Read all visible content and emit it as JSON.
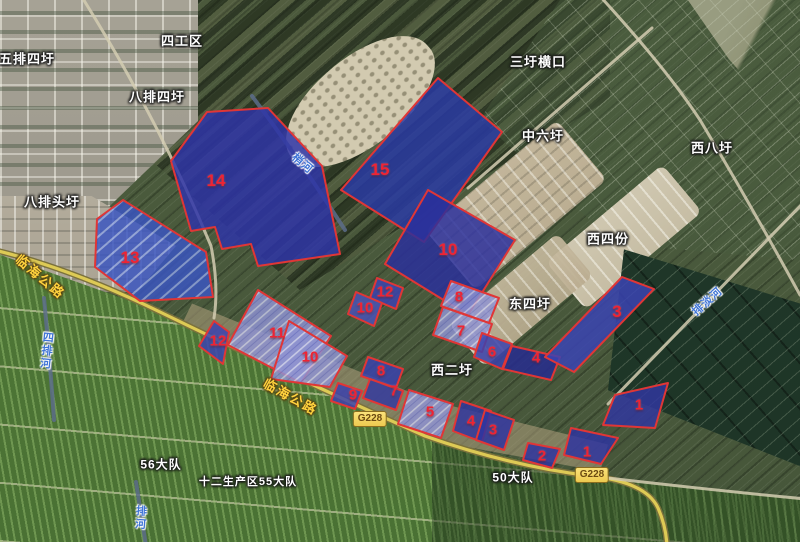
{
  "map": {
    "description": "satellite farmland map with numbered highlighted parcels",
    "colors": {
      "parcel_border": "#e03636",
      "parcel_fill_deep": "#2b309c",
      "parcel_fill_ponds": "#8f93d2",
      "number_red": "#ef2333",
      "road_yellow": "#ddca55",
      "river_blue": "#3f74d6",
      "label_white": "#ffffff"
    },
    "place_labels": [
      {
        "text": "五排四圩",
        "x": 27,
        "y": 58,
        "size": 13
      },
      {
        "text": "四工区",
        "x": 182,
        "y": 40,
        "size": 13
      },
      {
        "text": "八排四圩",
        "x": 157,
        "y": 96,
        "size": 13
      },
      {
        "text": "八排头圩",
        "x": 52,
        "y": 201,
        "size": 13
      },
      {
        "text": "三圩横口",
        "x": 538,
        "y": 61,
        "size": 13
      },
      {
        "text": "中六圩",
        "x": 543,
        "y": 135,
        "size": 13
      },
      {
        "text": "西八圩",
        "x": 712,
        "y": 147,
        "size": 13
      },
      {
        "text": "西四份",
        "x": 608,
        "y": 238,
        "size": 13
      },
      {
        "text": "东四圩",
        "x": 530,
        "y": 303,
        "size": 13
      },
      {
        "text": "西二圩",
        "x": 452,
        "y": 369,
        "size": 13
      },
      {
        "text": "56大队",
        "x": 161,
        "y": 464,
        "size": 12
      },
      {
        "text": "十二生产区55大队",
        "x": 248,
        "y": 481,
        "size": 11
      },
      {
        "text": "50大队",
        "x": 513,
        "y": 477,
        "size": 12
      }
    ],
    "road_labels": [
      {
        "text": "临海公路",
        "x": 41,
        "y": 276,
        "rotation": 40
      },
      {
        "text": "临海公路",
        "x": 291,
        "y": 396,
        "rotation": 29
      }
    ],
    "road_badges": [
      {
        "text": "G228",
        "x": 370,
        "y": 419
      },
      {
        "text": "G228",
        "x": 592,
        "y": 475
      }
    ],
    "river_labels": [
      {
        "text": "梢河",
        "x": 303,
        "y": 163,
        "rotation": 40,
        "vertical": false
      },
      {
        "text": "四排河",
        "x": 46,
        "y": 351,
        "rotation": 6,
        "vertical": true
      },
      {
        "text": "排淡河",
        "x": 707,
        "y": 301,
        "rotation": -42,
        "vertical": false
      },
      {
        "text": "排河",
        "x": 140,
        "y": 518,
        "rotation": 4,
        "vertical": true
      }
    ],
    "roads": [
      {
        "name": "linhai-g228-highway",
        "type": "main",
        "d": "M -6 250 Q 70 268 160 312 Q 300 380 425 436 Q 510 466 591 476"
      },
      {
        "name": "g228-south-branch",
        "type": "main",
        "d": "M 591 476 Q 646 482 658 508 Q 666 526 667 546"
      },
      {
        "name": "east-field-road",
        "type": "minor",
        "d": "M 591 476 Q 700 489 806 499"
      },
      {
        "name": "north-grey-road",
        "type": "minor",
        "d": "M 80 -6 Q 158 118 211 246 Q 219 286 214 318"
      },
      {
        "name": "coastal-road",
        "type": "minor",
        "d": "M 598 -6 Q 666 68 700 120 Q 748 200 800 295"
      },
      {
        "name": "paidan-canal-road",
        "type": "minor",
        "d": "M 608 404 L 806 200"
      },
      {
        "name": "zhongliuwei-road",
        "type": "minor",
        "d": "M 468 188 Q 560 108 652 28"
      },
      {
        "name": "shaohe-canal",
        "type": "canal",
        "d": "M 252 96 Q 300 160 345 230"
      },
      {
        "name": "sipaihe-canal",
        "type": "canal",
        "d": "M 44 298 Q 50 360 54 420"
      },
      {
        "name": "south-canal",
        "type": "canal",
        "d": "M 136 482 Q 141 514 146 546"
      }
    ],
    "parcels": [
      {
        "number": "14",
        "x": 216,
        "y": 181,
        "big": true,
        "fill": "#2f35a8",
        "points": "207,112 268,108 322,166 340,254 258,266 251,244 222,249 215,227 191,231 171,161"
      },
      {
        "number": "15",
        "x": 380,
        "y": 170,
        "big": true,
        "fill": "#2a3aa4",
        "points": "438,78 502,132 424,242 341,190"
      },
      {
        "number": "13",
        "x": 130,
        "y": 258,
        "big": true,
        "fill": "#3a55c0",
        "texture": "ponds-blue",
        "points": "123,200 206,252 213,297 140,301 95,267 97,219"
      },
      {
        "number": "12",
        "x": 218,
        "y": 341,
        "big": false,
        "fill": "#3c43b0",
        "points": "214,321 229,332 223,364 199,346"
      },
      {
        "number": "11",
        "x": 277,
        "y": 333,
        "big": false,
        "fill": "#4a52b8",
        "texture": "ponds",
        "points": "258,290 331,336 301,383 228,345"
      },
      {
        "number": "10",
        "x": 310,
        "y": 357,
        "big": false,
        "fill": "#8d90cf",
        "texture": "ponds",
        "points": "289,321 347,356 330,387 271,379"
      },
      {
        "number": "12",
        "x": 385,
        "y": 292,
        "big": false,
        "fill": "#3c43b0",
        "points": "377,278 403,288 396,309 370,298"
      },
      {
        "number": "10",
        "x": 365,
        "y": 308,
        "big": false,
        "fill": "#4a52b8",
        "points": "356,292 382,303 374,326 348,314"
      },
      {
        "number": "10",
        "x": 448,
        "y": 250,
        "big": true,
        "fill": "#2b309c",
        "points": "428,190 515,240 468,315 385,264"
      },
      {
        "number": "8",
        "x": 459,
        "y": 297,
        "big": false,
        "fill": "#3f48b4",
        "texture": "ponds",
        "points": "451,281 499,298 489,323 441,306"
      },
      {
        "number": "7",
        "x": 461,
        "y": 331,
        "big": false,
        "fill": "#8d90cf",
        "texture": "ponds",
        "points": "443,307 492,324 482,352 433,335"
      },
      {
        "number": "6",
        "x": 492,
        "y": 352,
        "big": false,
        "fill": "#3a41ae",
        "points": "482,333 512,344 502,369 474,357"
      },
      {
        "number": "4",
        "x": 536,
        "y": 358,
        "big": false,
        "fill": "#262b90",
        "points": "512,346 560,357 551,380 503,369"
      },
      {
        "number": "3",
        "x": 617,
        "y": 312,
        "big": true,
        "fill": "#3a44b4",
        "points": "622,277 654,289 574,372 545,357"
      },
      {
        "number": "8",
        "x": 381,
        "y": 371,
        "big": false,
        "fill": "#3a41ae",
        "points": "368,357 403,369 396,388 361,376"
      },
      {
        "number": "7",
        "x": 394,
        "y": 391,
        "big": false,
        "fill": "#333a9e",
        "points": "370,379 403,391 396,410 363,398"
      },
      {
        "number": "9",
        "x": 353,
        "y": 395,
        "big": false,
        "fill": "#3a41ae",
        "points": "338,383 362,391 355,409 331,401"
      },
      {
        "number": "5",
        "x": 430,
        "y": 412,
        "big": false,
        "fill": "#2d339e",
        "texture": "ponds",
        "points": "409,390 453,404 441,438 398,424"
      },
      {
        "number": "4",
        "x": 471,
        "y": 421,
        "big": false,
        "fill": "#31379e",
        "points": "461,401 491,411 482,442 453,431"
      },
      {
        "number": "3",
        "x": 493,
        "y": 430,
        "big": false,
        "fill": "#2e34a0",
        "points": "485,410 514,420 504,450 476,440"
      },
      {
        "number": "2",
        "x": 542,
        "y": 456,
        "big": false,
        "fill": "#2e34a0",
        "points": "528,443 560,449 552,468 523,460"
      },
      {
        "number": "1",
        "x": 587,
        "y": 452,
        "big": false,
        "fill": "#2e34a0",
        "points": "571,428 618,438 601,464 564,455"
      },
      {
        "number": "1",
        "x": 639,
        "y": 405,
        "big": false,
        "fill": "#31379e",
        "points": "615,395 668,383 655,428 603,425"
      }
    ]
  }
}
